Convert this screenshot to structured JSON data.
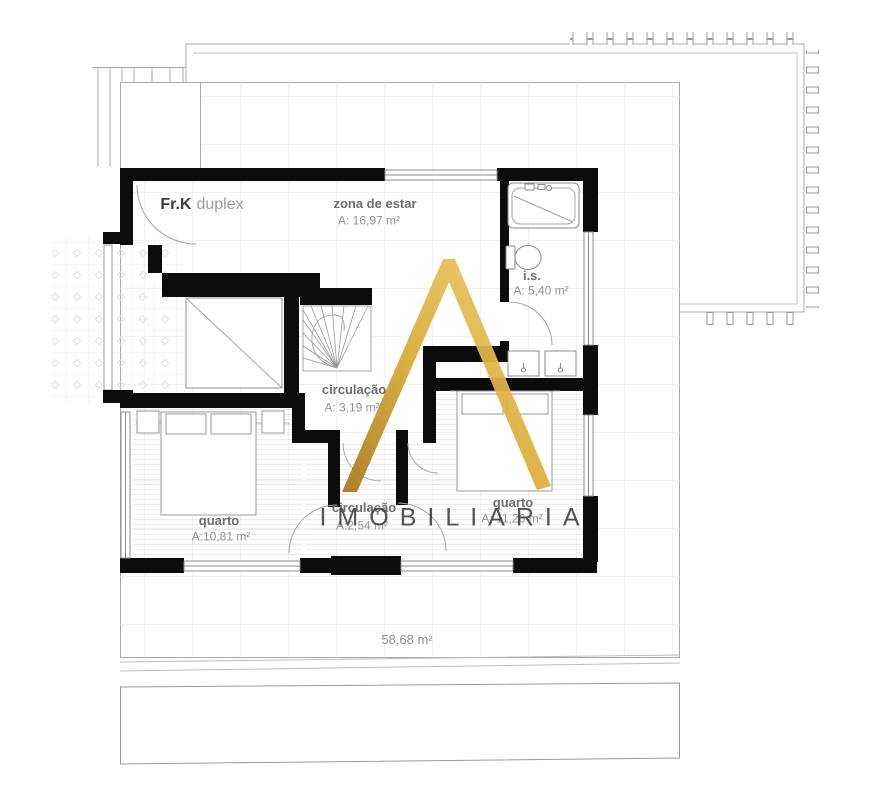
{
  "unit": {
    "type_label": "Fr.K",
    "type_suffix": "duplex"
  },
  "rooms": {
    "living": {
      "name": "zona de estar",
      "area": "A: 16,97 m²"
    },
    "bathroom": {
      "name": "i.s.",
      "area": "A: 5,40 m²"
    },
    "circulation_upper": {
      "name": "circulação",
      "area": "A: 3,19 m²"
    },
    "bedroom_left": {
      "name": "quarto",
      "area": "A:10,81 m²"
    },
    "circulation_lower": {
      "name": "circulação",
      "area": "A:2,54 m²"
    },
    "bedroom_right": {
      "name": "quarto",
      "area": "A: 11,26 m²"
    }
  },
  "totals": {
    "floor_area": "58,68 m²"
  },
  "watermark": {
    "letter": "A",
    "text": "IMOBILIARIA",
    "gold_dark": "#b07d1a",
    "gold_light": "#eecd70",
    "text_color": "#3b3b3b"
  }
}
